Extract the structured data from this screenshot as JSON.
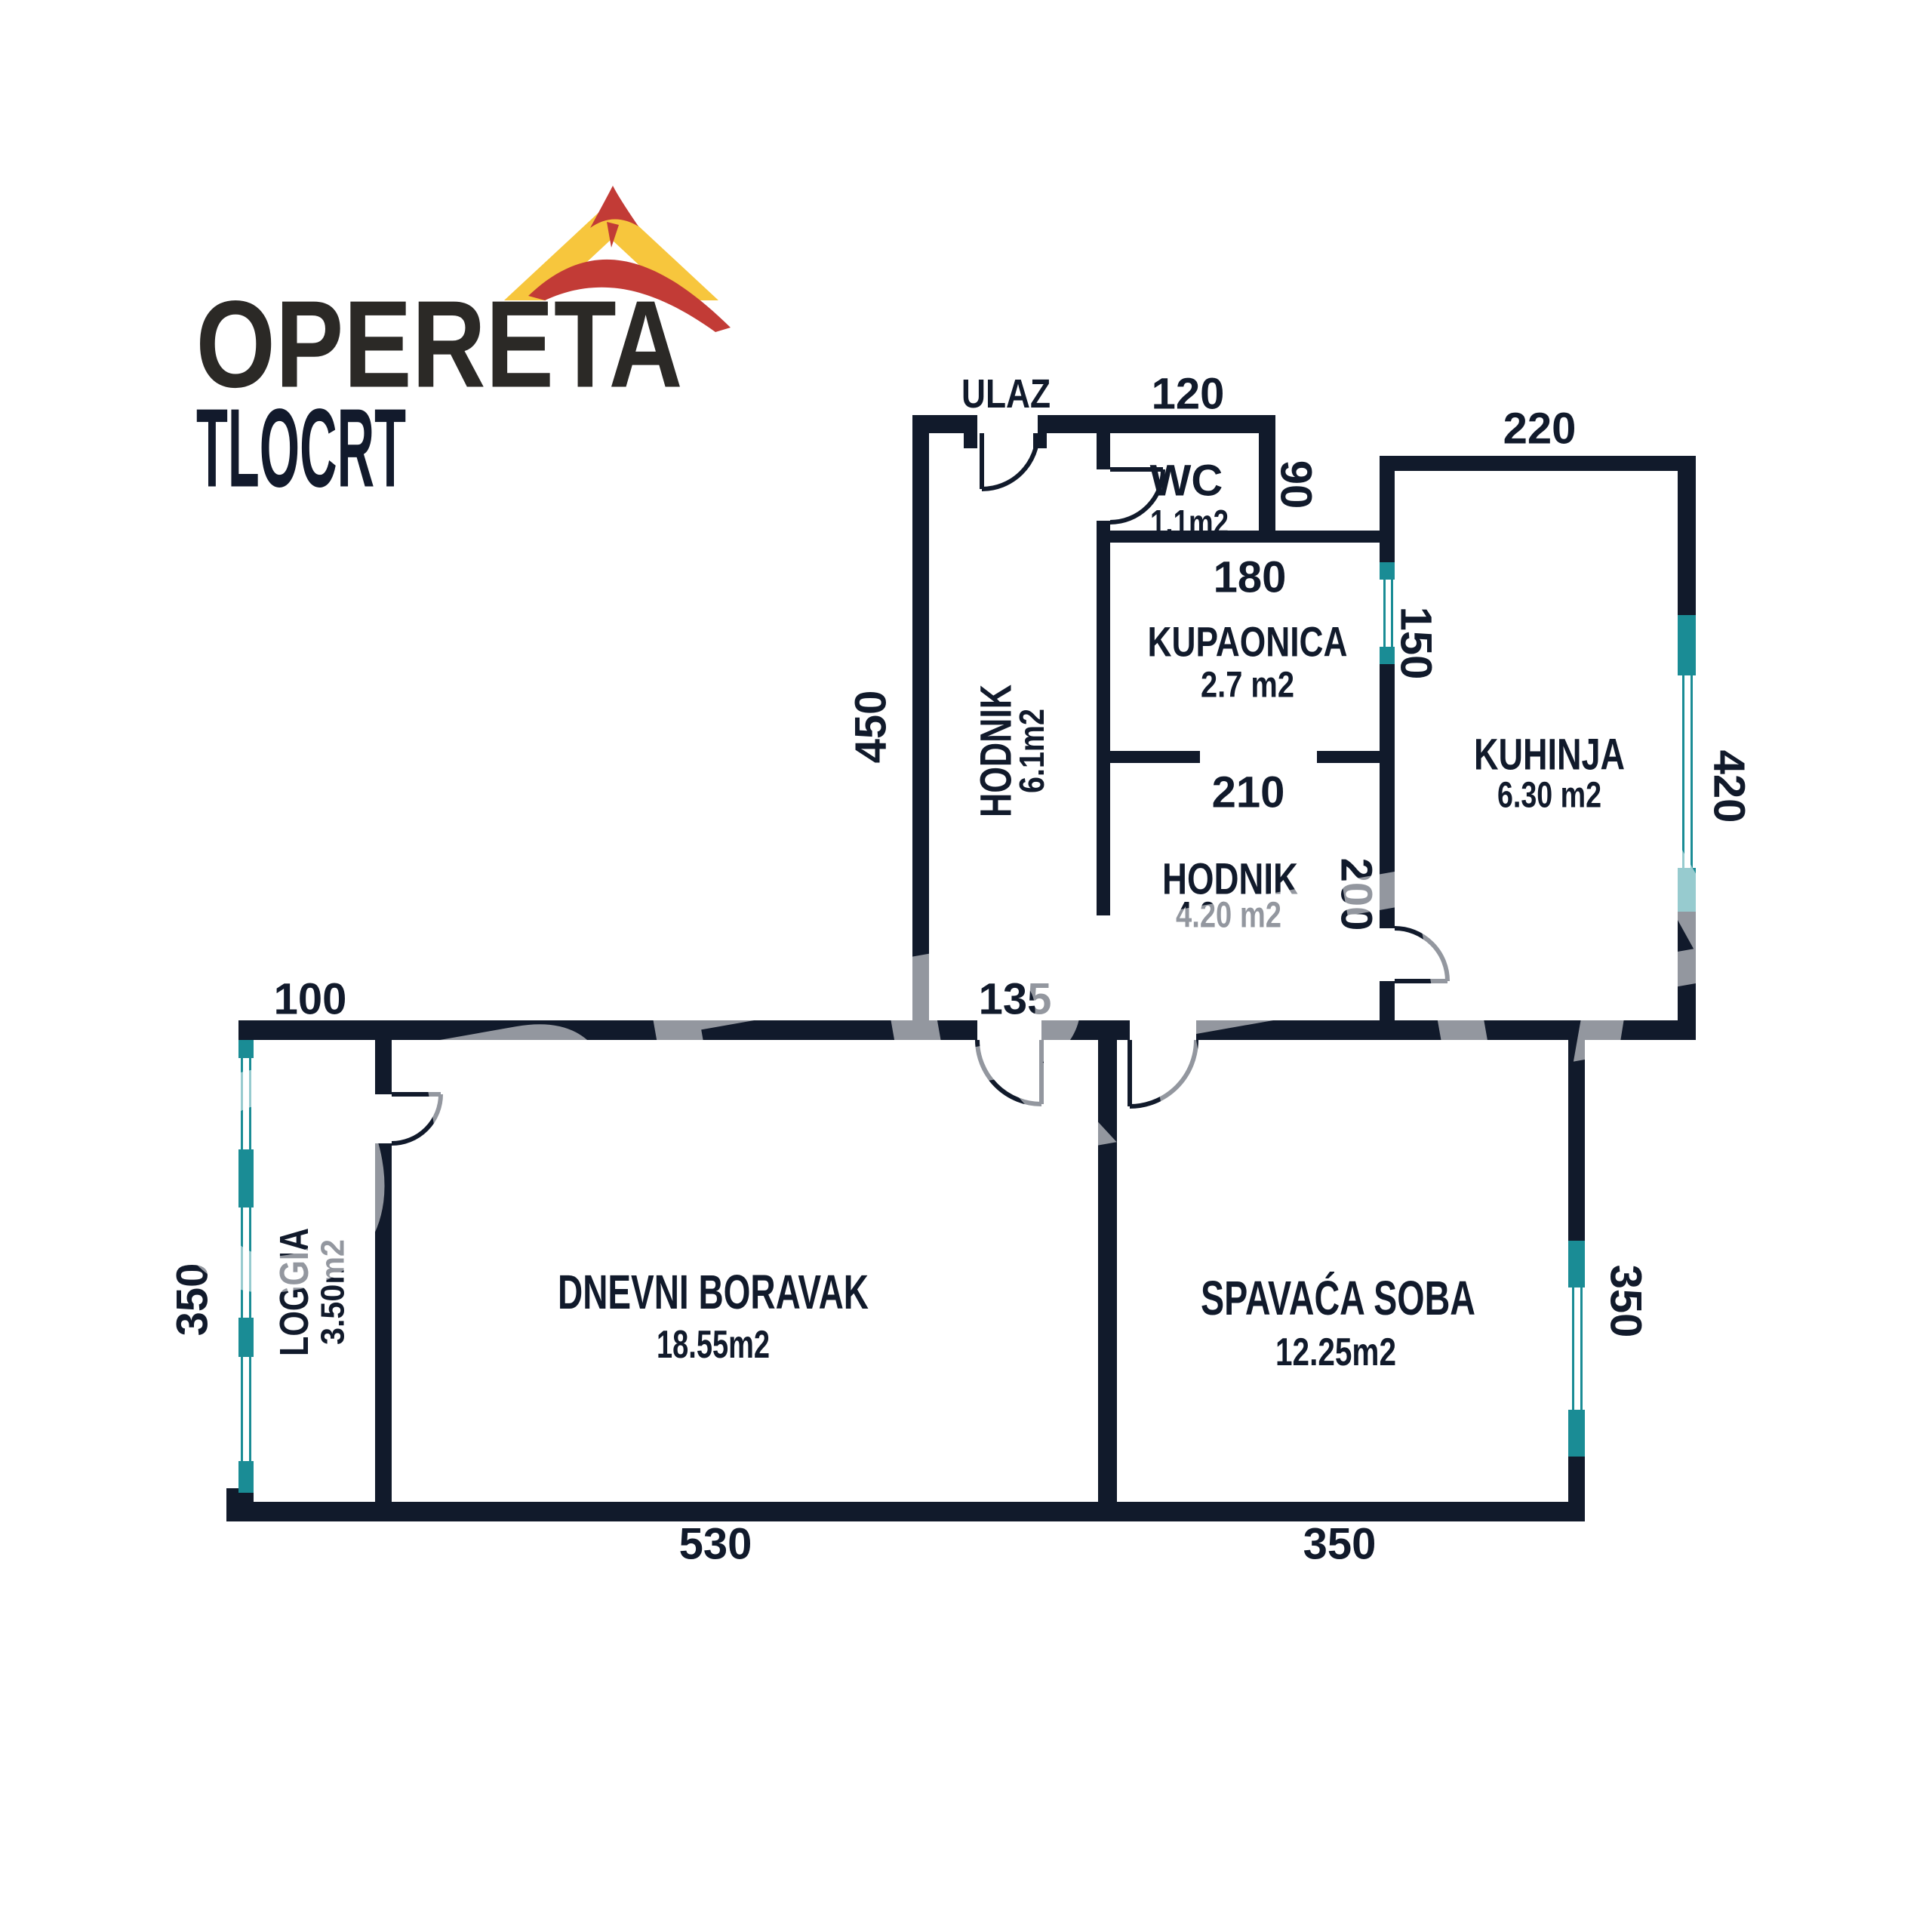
{
  "logo": {
    "brand": "OPERETA",
    "subtitle": "TLOCRT"
  },
  "watermark": "OPERETA",
  "entrance_label": "ULAZ",
  "colors": {
    "wall": "#111A2B",
    "window": "#1A8C95",
    "logo_text": "#2B2926",
    "subtitle_text": "#121A2C",
    "roof_yellow": "#F7C63D",
    "bird_red": "#C23B36",
    "watermark": "rgba(255,255,255,0.55)"
  },
  "rooms": {
    "hodnik1": {
      "name": "HODNIK",
      "area": "6.1m2"
    },
    "wc": {
      "name": "WC",
      "area": "1.1m2"
    },
    "kupaonica": {
      "name": "KUPAONICA",
      "area": "2.7 m2"
    },
    "hodnik2": {
      "name": "HODNIK",
      "area": "4.20 m2"
    },
    "kuhinja": {
      "name": "KUHINJA",
      "area": "6.30 m2"
    },
    "dnevni_boravak": {
      "name": "DNEVNI BORAVAK",
      "area": "18.55m2"
    },
    "spavaca_soba": {
      "name": "SPAVAĆA SOBA",
      "area": "12.25m2"
    },
    "loggia": {
      "name": "LOGGIA",
      "area": "3.50m2"
    }
  },
  "dimensions_cm": {
    "wc_width": "120",
    "wc_height": "90",
    "kupaonica_width": "180",
    "bath_kitchen_window": "150",
    "kuhinja_width": "220",
    "kuhinja_height": "420",
    "hodnik1_height": "450",
    "hodnik1_width": "135",
    "hodnik2_width": "210",
    "hodnik2_height": "200",
    "loggia_width": "100",
    "loggia_height": "350",
    "dnevni_width": "530",
    "spavaca_width": "350",
    "spavaca_height": "350"
  }
}
